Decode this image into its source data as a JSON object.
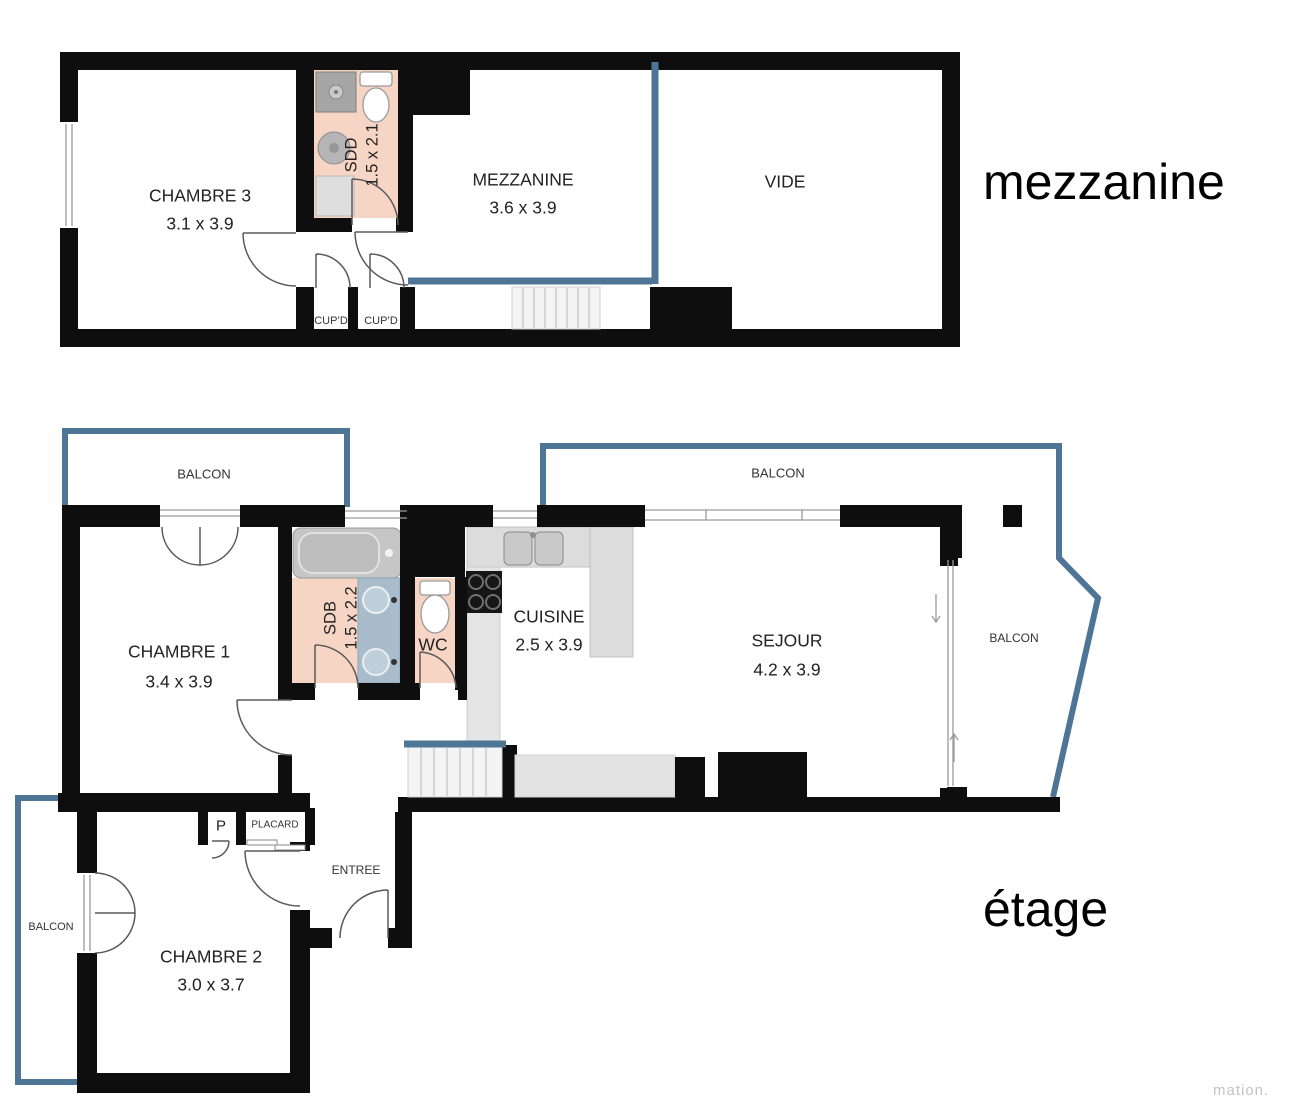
{
  "floors": {
    "mezzanine": {
      "title": "mezzanine",
      "rooms": {
        "chambre3": {
          "name": "CHAMBRE 3",
          "dims": "3.1 x 3.9"
        },
        "sdd": {
          "name": "SDD",
          "dims": "1.5 x 2.1"
        },
        "mezz": {
          "name": "MEZZANINE",
          "dims": "3.6 x 3.9"
        },
        "vide": {
          "name": "VIDE"
        },
        "cupd_left": {
          "name": "CUP’D"
        },
        "cupd_right": {
          "name": "CUP’D"
        }
      }
    },
    "etage": {
      "title": "étage",
      "rooms": {
        "balcon_top_left": {
          "name": "BALCON"
        },
        "balcon_top_right": {
          "name": "BALCON"
        },
        "balcon_right": {
          "name": "BALCON"
        },
        "balcon_left": {
          "name": "BALCON"
        },
        "chambre1": {
          "name": "CHAMBRE 1",
          "dims": "3.4 x 3.9"
        },
        "sdb": {
          "name": "SDB",
          "dims": "1.5 x 2.2"
        },
        "wc": {
          "name": "WC"
        },
        "cuisine": {
          "name": "CUISINE",
          "dims": "2.5 x 3.9"
        },
        "sejour": {
          "name": "SEJOUR",
          "dims": "4.2 x 3.9"
        },
        "chambre2": {
          "name": "CHAMBRE 2",
          "dims": "3.0 x 3.7"
        },
        "entree": {
          "name": "ENTREE"
        },
        "placard": {
          "name": "PLACARD"
        },
        "p_closet": {
          "name": "P"
        }
      }
    }
  },
  "watermark": "mation.",
  "colors": {
    "wall": "#0e0e0e",
    "balcony_line": "#4e7596",
    "wet_floor": "#f7d5c5",
    "counter": "#dcdcdc",
    "vanity": "#a9bccb"
  }
}
